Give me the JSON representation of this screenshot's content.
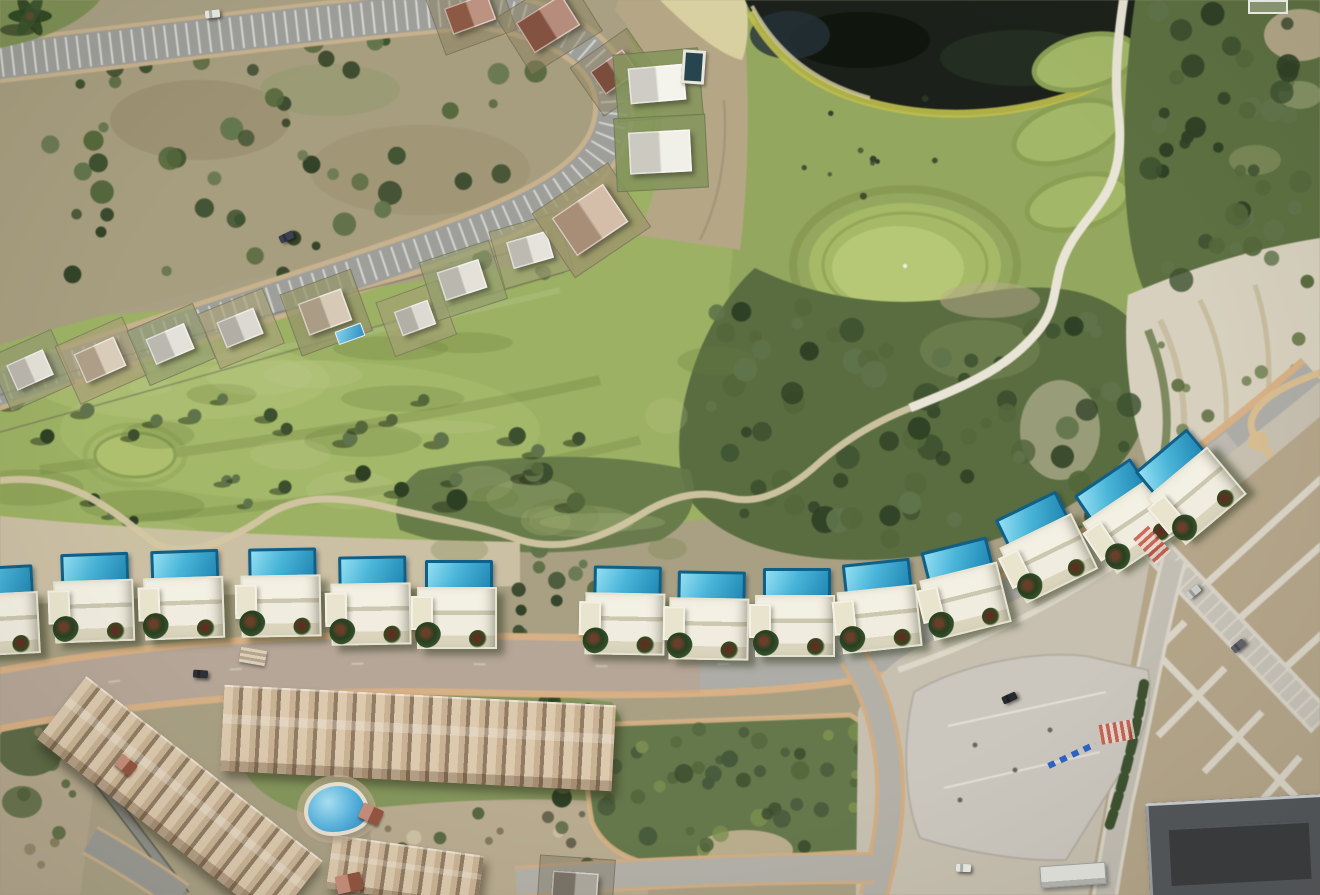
{
  "scene": {
    "type": "aerial-satellite-photo",
    "description": "Aerial view of a golf resort hillside: dark pond and golf fairways with putting greens at top, dense scrub, a curving residential street lined with newly rendered white villas with rooftop blue pools, an existing villa row upper-left, an apartment complex with free-form pool at bottom-left, and a new urban parking zone with dirt lots at bottom-right.",
    "visible_text": ""
  },
  "palette": {
    "ground_tan": "#a9a083",
    "golf_green": "#9cb161",
    "putting_green": "#b6c773",
    "scrub_dark": "#5a6d40",
    "pond_water": "#1b211a",
    "pond_algae": "#c0bf4a",
    "road_gray": "#a5a4a0",
    "curb_beige": "#d9b083",
    "villa_body": "#f0ecdf",
    "villa_pool_water": "#4ab5d9",
    "villa_pool_border": "#0e6089",
    "apartment_roof": "#cdb497",
    "parking_concrete": "#cbc7bf",
    "chalk_slope": "#d7d0bd",
    "urban_dirt": "#b5a689"
  },
  "new_villas": {
    "count": 14,
    "items": [
      {
        "x": -45,
        "y": 566,
        "rot": -3,
        "partial": true
      },
      {
        "x": 50,
        "y": 553,
        "rot": -2
      },
      {
        "x": 140,
        "y": 550,
        "rot": -2
      },
      {
        "x": 237,
        "y": 548,
        "rot": -1
      },
      {
        "x": 327,
        "y": 556,
        "rot": -1
      },
      {
        "x": 413,
        "y": 560,
        "rot": 0
      },
      {
        "x": 581,
        "y": 566,
        "rot": 1
      },
      {
        "x": 665,
        "y": 571,
        "rot": 1
      },
      {
        "x": 751,
        "y": 568,
        "rot": 0
      },
      {
        "x": 835,
        "y": 561,
        "rot": -6
      },
      {
        "x": 920,
        "y": 543,
        "rot": -14
      },
      {
        "x": 1002,
        "y": 500,
        "rot": -26
      },
      {
        "x": 1085,
        "y": 468,
        "rot": -34
      },
      {
        "x": 1148,
        "y": 438,
        "rot": -40
      }
    ]
  },
  "existing_houses": {
    "items": [
      {
        "cx": 30,
        "cy": 370,
        "rot": -24,
        "w": 40,
        "h": 28,
        "roof": "#d8d4c9",
        "plot": "rgba(150,158,112,0.75)"
      },
      {
        "cx": 100,
        "cy": 360,
        "rot": -24,
        "w": 44,
        "h": 32,
        "roof": "#cbb89d",
        "plot": "rgba(170,160,120,0.7)"
      },
      {
        "cx": 170,
        "cy": 344,
        "rot": -23,
        "w": 42,
        "h": 28,
        "roof": "#dad6cc",
        "plot": "rgba(150,158,112,0.7)"
      },
      {
        "cx": 240,
        "cy": 328,
        "rot": -22,
        "w": 40,
        "h": 28,
        "roof": "#cfcbc1",
        "plot": "rgba(168,162,120,0.7)"
      },
      {
        "cx": 325,
        "cy": 312,
        "rot": -20,
        "w": 46,
        "h": 34,
        "roof": "#c6b69b",
        "plot": "rgba(150,150,105,0.75)",
        "pool": {
          "dx": 2,
          "dy": 22,
          "w": 26,
          "h": 12
        }
      },
      {
        "cx": 415,
        "cy": 318,
        "rot": -20,
        "w": 36,
        "h": 26,
        "roof": "#cfccc2",
        "plot": "rgba(165,160,118,0.65)"
      },
      {
        "cx": 462,
        "cy": 280,
        "rot": -18,
        "w": 44,
        "h": 30,
        "roof": "#d9d5cb",
        "plot": "rgba(150,158,112,0.7)"
      },
      {
        "cx": 530,
        "cy": 250,
        "rot": -16,
        "w": 42,
        "h": 28,
        "roof": "#dcd8ce",
        "plot": "rgba(160,160,115,0.7)"
      },
      {
        "cx": 590,
        "cy": 220,
        "rot": -34,
        "w": 62,
        "h": 46,
        "roof": "#c3a58a",
        "plot": "rgba(158,150,108,0.8)"
      },
      {
        "cx": 470,
        "cy": 14,
        "rot": -20,
        "w": 46,
        "h": 28,
        "roof": "#a2684f",
        "plot": "rgba(140,130,95,0.5)"
      },
      {
        "cx": 548,
        "cy": 24,
        "rot": -32,
        "w": 54,
        "h": 36,
        "roof": "#9a5f4a",
        "plot": "rgba(140,130,95,0.5)"
      },
      {
        "cx": 614,
        "cy": 72,
        "rot": -35,
        "w": 40,
        "h": 28,
        "roof": "#8f5a47",
        "plot": "rgba(140,130,95,0.45)"
      },
      {
        "cx": 657,
        "cy": 84,
        "rot": -5,
        "w": 56,
        "h": 36,
        "roof": "#f0eee4",
        "plot": "rgba(130,148,90,0.85)"
      },
      {
        "cx": 660,
        "cy": 152,
        "rot": -3,
        "w": 62,
        "h": 42,
        "roof": "#eceadf",
        "plot": "rgba(130,148,90,0.85)"
      },
      {
        "cx": 575,
        "cy": 885,
        "rot": 4,
        "w": 46,
        "h": 26,
        "roof": "#8d8678",
        "plot": "rgba(120,115,95,0.4)"
      }
    ]
  },
  "apartments": {
    "blocks": [
      {
        "cx": 418,
        "cy": 738,
        "w": 392,
        "h": 86,
        "rot": 3
      },
      {
        "cx": 180,
        "cy": 800,
        "w": 300,
        "h": 80,
        "rot": 38
      },
      {
        "cx": 405,
        "cy": 872,
        "w": 152,
        "h": 54,
        "rot": 8
      }
    ],
    "pool": {
      "x": 304,
      "y": 782
    }
  },
  "cars": [
    {
      "x": 205,
      "y": 10,
      "rot": -6,
      "color": "#e9e9e5"
    },
    {
      "x": 279,
      "y": 233,
      "rot": -25,
      "color": "#3a4150"
    },
    {
      "x": 193,
      "y": 670,
      "rot": 4,
      "color": "#2d3136"
    },
    {
      "x": 1002,
      "y": 694,
      "rot": -24,
      "color": "#26292e"
    },
    {
      "x": 956,
      "y": 864,
      "rot": 2,
      "color": "#eaeae6"
    },
    {
      "x": 1186,
      "y": 588,
      "rot": -40,
      "color": "#cbcdcb"
    },
    {
      "x": 1231,
      "y": 642,
      "rot": -40,
      "color": "#5e6268"
    }
  ],
  "features": [
    {
      "type": "crosswalk",
      "x": 1135,
      "y": 535,
      "rot": 48
    },
    {
      "type": "crosswalk",
      "x": 1100,
      "y": 722,
      "rot": -10
    },
    {
      "type": "stairs",
      "x": 240,
      "y": 648,
      "rot": 10
    },
    {
      "type": "lap-pool",
      "x": 682,
      "y": 50,
      "rot": 4
    },
    {
      "type": "blue-marking",
      "x": 1046,
      "y": 752,
      "rot": -25
    },
    {
      "type": "white-structure",
      "x": 1248,
      "y": 0,
      "rot": 0
    },
    {
      "type": "apartment-pool",
      "x": 304,
      "y": 782,
      "rot": 0
    },
    {
      "type": "dark-building",
      "x": 1148,
      "y": 798,
      "rot": 0
    },
    {
      "type": "white-building",
      "x": 1040,
      "y": 864,
      "rot": -4
    },
    {
      "type": "terracotta",
      "x": 360,
      "y": 806,
      "rot": 25,
      "w": 22,
      "h": 16
    },
    {
      "type": "terracotta",
      "x": 336,
      "y": 874,
      "rot": -12,
      "w": 26,
      "h": 18
    },
    {
      "type": "terracotta",
      "x": 116,
      "y": 758,
      "rot": 40,
      "w": 20,
      "h": 14
    }
  ]
}
